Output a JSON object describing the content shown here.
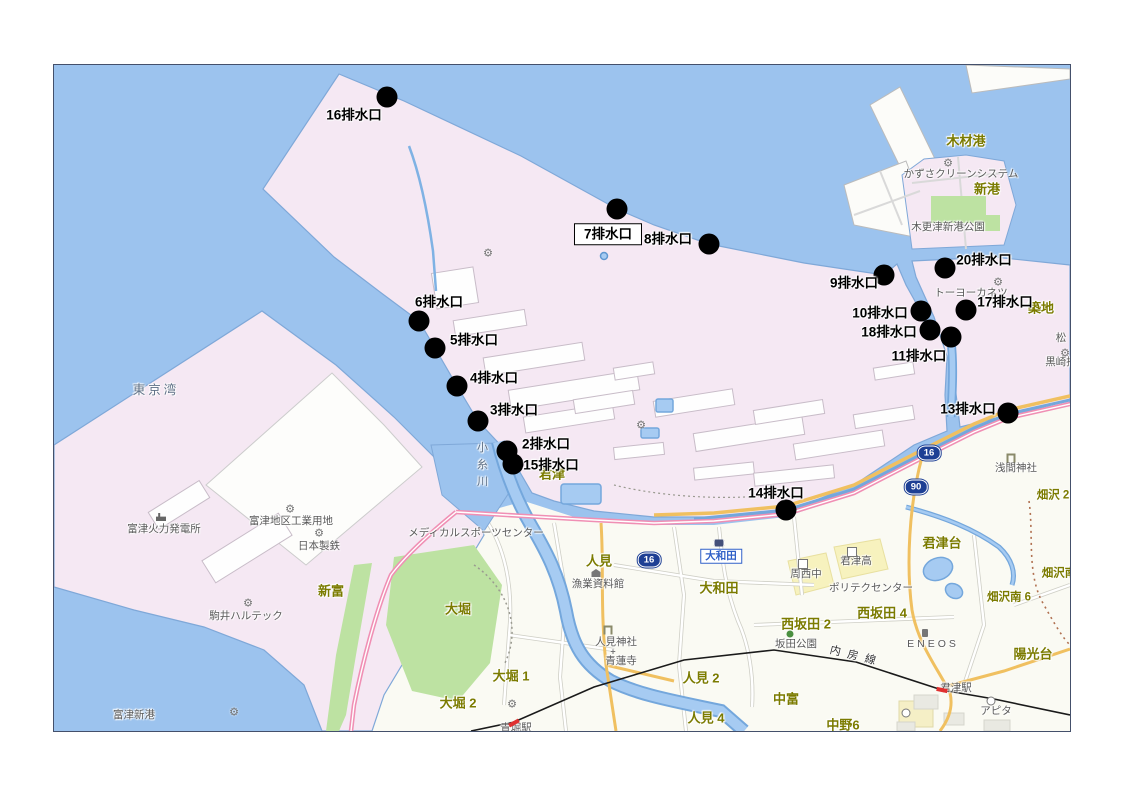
{
  "map": {
    "frame": {
      "left": 53,
      "top": 64,
      "width": 1016,
      "height": 666
    },
    "colors": {
      "sea": "#9CC3EE",
      "industrial_land": "#F5E8F3",
      "urban_land": "#FAFAF3",
      "park_green": "#BDE2A2",
      "school_yellow": "#F7F2BE",
      "coast_stroke": "#7FA8D8",
      "road_pink": "#F08FB4",
      "road_orange": "#F0C060",
      "railway": "#1a1a1a",
      "shield_blue": "#1d3f94",
      "outlet_dot": "#000000",
      "place_label": "#7b7b00",
      "facility_label": "#595959"
    },
    "outlets": [
      {
        "label": "16排水口",
        "dot": {
          "x": 333,
          "y": 32
        },
        "label_pos": {
          "x": 300,
          "y": 50
        },
        "boxed": false
      },
      {
        "label": "7排水口",
        "dot": {
          "x": 563,
          "y": 144
        },
        "label_pos": {
          "x": 554,
          "y": 169
        },
        "boxed": true
      },
      {
        "label": "8排水口",
        "dot": {
          "x": 655,
          "y": 179
        },
        "label_pos": {
          "x": 614,
          "y": 174
        },
        "boxed": false
      },
      {
        "label": "9排水口",
        "dot": {
          "x": 830,
          "y": 210
        },
        "label_pos": {
          "x": 800,
          "y": 218
        },
        "boxed": false
      },
      {
        "label": "10排水口",
        "dot": {
          "x": 867,
          "y": 246
        },
        "label_pos": {
          "x": 826,
          "y": 248
        },
        "boxed": false
      },
      {
        "label": "18排水口",
        "dot": {
          "x": 876,
          "y": 265
        },
        "label_pos": {
          "x": 835,
          "y": 267
        },
        "boxed": false
      },
      {
        "label": "11排水口",
        "dot": {
          "x": 897,
          "y": 272
        },
        "label_pos": {
          "x": 865,
          "y": 291
        },
        "boxed": false
      },
      {
        "label": "20排水口",
        "dot": {
          "x": 891,
          "y": 203
        },
        "label_pos": {
          "x": 930,
          "y": 195
        },
        "boxed": false
      },
      {
        "label": "17排水口",
        "dot": {
          "x": 912,
          "y": 245
        },
        "label_pos": {
          "x": 951,
          "y": 237
        },
        "boxed": false
      },
      {
        "label": "13排水口",
        "dot": {
          "x": 954,
          "y": 348
        },
        "label_pos": {
          "x": 914,
          "y": 344
        },
        "boxed": false
      },
      {
        "label": "14排水口",
        "dot": {
          "x": 732,
          "y": 445
        },
        "label_pos": {
          "x": 722,
          "y": 428
        },
        "boxed": false
      },
      {
        "label": "6排水口",
        "dot": {
          "x": 365,
          "y": 256
        },
        "label_pos": {
          "x": 385,
          "y": 237
        },
        "boxed": false
      },
      {
        "label": "5排水口",
        "dot": {
          "x": 381,
          "y": 283
        },
        "label_pos": {
          "x": 420,
          "y": 275
        },
        "boxed": false
      },
      {
        "label": "4排水口",
        "dot": {
          "x": 403,
          "y": 321
        },
        "label_pos": {
          "x": 440,
          "y": 313
        },
        "boxed": false
      },
      {
        "label": "3排水口",
        "dot": {
          "x": 424,
          "y": 356
        },
        "label_pos": {
          "x": 460,
          "y": 345
        },
        "boxed": false
      },
      {
        "label": "2排水口",
        "dot": {
          "x": 453,
          "y": 386
        },
        "label_pos": {
          "x": 492,
          "y": 379
        },
        "boxed": false
      },
      {
        "label": "15排水口",
        "dot": {
          "x": 459,
          "y": 399
        },
        "label_pos": {
          "x": 497,
          "y": 400
        },
        "boxed": false
      }
    ],
    "labels": [
      {
        "kind": "place",
        "text": "木材港",
        "x": 912,
        "y": 76
      },
      {
        "kind": "place",
        "text": "新港",
        "x": 933,
        "y": 124
      },
      {
        "kind": "place",
        "text": "築地",
        "x": 987,
        "y": 243
      },
      {
        "kind": "place",
        "text": "新富",
        "x": 277,
        "y": 526
      },
      {
        "kind": "place",
        "text": "君津",
        "x": 498,
        "y": 409
      },
      {
        "kind": "place",
        "text": "大堀",
        "x": 404,
        "y": 544
      },
      {
        "kind": "place",
        "text": "大堀 1",
        "x": 457,
        "y": 611
      },
      {
        "kind": "place",
        "text": "大堀 2",
        "x": 404,
        "y": 638
      },
      {
        "kind": "place",
        "text": "人見",
        "x": 545,
        "y": 496
      },
      {
        "kind": "place",
        "text": "人見 2",
        "x": 647,
        "y": 613
      },
      {
        "kind": "place",
        "text": "人見 4",
        "x": 652,
        "y": 653
      },
      {
        "kind": "place",
        "text": "大和田",
        "x": 665,
        "y": 523
      },
      {
        "kind": "place",
        "text": "中富",
        "x": 732,
        "y": 634
      },
      {
        "kind": "place",
        "text": "中野6",
        "x": 789,
        "y": 660
      },
      {
        "kind": "place",
        "text": "西坂田 2",
        "x": 752,
        "y": 559
      },
      {
        "kind": "place",
        "text": "西坂田 4",
        "x": 828,
        "y": 548
      },
      {
        "kind": "place",
        "text": "君津台",
        "x": 888,
        "y": 478
      },
      {
        "kind": "place-sm",
        "text": "畑沢 2",
        "x": 999,
        "y": 431
      },
      {
        "kind": "place-sm",
        "text": "畑沢南",
        "x": 1005,
        "y": 509
      },
      {
        "kind": "place-sm",
        "text": "畑沢南 6",
        "x": 955,
        "y": 533
      },
      {
        "kind": "place",
        "text": "陽光台",
        "x": 979,
        "y": 589
      },
      {
        "kind": "water",
        "text": "東京湾",
        "x": 102,
        "y": 325
      },
      {
        "kind": "water-v",
        "text": "小糸川",
        "x": 427,
        "y": 402
      },
      {
        "kind": "facility",
        "text": "富津新港",
        "x": 80,
        "y": 650
      },
      {
        "kind": "facility",
        "text": "かずさクリーンシステム",
        "x": 907,
        "y": 109
      },
      {
        "kind": "facility",
        "text": "木更津新港公園",
        "x": 894,
        "y": 162
      },
      {
        "kind": "facility",
        "text": "トーヨーカネツ",
        "x": 917,
        "y": 228
      },
      {
        "kind": "facility",
        "text": "松",
        "x": 1007,
        "y": 273
      },
      {
        "kind": "facility",
        "text": "黒崎播",
        "x": 1007,
        "y": 297
      },
      {
        "kind": "facility",
        "text": "富津火力発電所",
        "x": 110,
        "y": 464
      },
      {
        "kind": "facility",
        "text": "富津地区工業用地",
        "x": 237,
        "y": 456
      },
      {
        "kind": "facility",
        "text": "日本製鉄",
        "x": 265,
        "y": 481
      },
      {
        "kind": "facility",
        "text": "駒井ハルテック",
        "x": 192,
        "y": 551
      },
      {
        "kind": "facility",
        "text": "メディカルスポーツセンター",
        "x": 422,
        "y": 468
      },
      {
        "kind": "facility",
        "text": "漁業資料館",
        "x": 544,
        "y": 519
      },
      {
        "kind": "facility",
        "text": "人見神社",
        "x": 562,
        "y": 577
      },
      {
        "kind": "facility",
        "text": "青蓮寺",
        "x": 567,
        "y": 596
      },
      {
        "kind": "facility",
        "text": "周西中",
        "x": 752,
        "y": 509
      },
      {
        "kind": "facility",
        "text": "君津高",
        "x": 802,
        "y": 496
      },
      {
        "kind": "facility",
        "text": "ポリテクセンター",
        "x": 817,
        "y": 523
      },
      {
        "kind": "facility",
        "text": "坂田公園",
        "x": 742,
        "y": 579
      },
      {
        "kind": "facility-sp",
        "text": "ENEOS",
        "x": 879,
        "y": 579
      },
      {
        "kind": "facility",
        "text": "浅間神社",
        "x": 962,
        "y": 403
      },
      {
        "kind": "facility",
        "text": "君津駅",
        "x": 902,
        "y": 623
      },
      {
        "kind": "facility",
        "text": "アピタ",
        "x": 942,
        "y": 646
      },
      {
        "kind": "facility",
        "text": "青堀駅",
        "x": 462,
        "y": 663
      },
      {
        "kind": "rail",
        "text": "内房線",
        "x": 802,
        "y": 592
      }
    ],
    "route_shields": [
      {
        "number": "16",
        "x": 875,
        "y": 388
      },
      {
        "number": "90",
        "x": 862,
        "y": 422
      },
      {
        "number": "16",
        "x": 595,
        "y": 495
      }
    ],
    "station_boxes": [
      {
        "label": "大和田",
        "x": 667,
        "y": 491
      }
    ],
    "icons": [
      {
        "type": "gear",
        "x": 894,
        "y": 99
      },
      {
        "type": "gear",
        "x": 944,
        "y": 218
      },
      {
        "type": "gear",
        "x": 1011,
        "y": 289
      },
      {
        "type": "gear",
        "x": 236,
        "y": 445
      },
      {
        "type": "gear",
        "x": 265,
        "y": 469
      },
      {
        "type": "gear",
        "x": 194,
        "y": 539
      },
      {
        "type": "gear",
        "x": 434,
        "y": 189
      },
      {
        "type": "gear",
        "x": 587,
        "y": 361
      },
      {
        "type": "gear",
        "x": 180,
        "y": 648
      },
      {
        "type": "gear",
        "x": 458,
        "y": 640
      },
      {
        "type": "factory",
        "x": 107,
        "y": 452
      },
      {
        "type": "school",
        "x": 749,
        "y": 499
      },
      {
        "type": "school",
        "x": 798,
        "y": 487
      },
      {
        "type": "torii",
        "x": 957,
        "y": 393
      },
      {
        "type": "torii",
        "x": 554,
        "y": 565
      },
      {
        "type": "temple",
        "x": 559,
        "y": 587
      },
      {
        "type": "museum",
        "x": 542,
        "y": 508
      },
      {
        "type": "park",
        "x": 736,
        "y": 569
      },
      {
        "type": "gas",
        "x": 871,
        "y": 568
      },
      {
        "type": "train",
        "x": 665,
        "y": 478
      },
      {
        "type": "tick",
        "x": 888,
        "y": 625,
        "rotate": 12
      },
      {
        "type": "tick",
        "x": 460,
        "y": 658,
        "rotate": -28
      },
      {
        "type": "poi",
        "x": 852,
        "y": 648
      },
      {
        "type": "poi",
        "x": 937,
        "y": 636
      }
    ],
    "icon_glyphs": {
      "gear": "⚙",
      "temple": "+"
    }
  }
}
